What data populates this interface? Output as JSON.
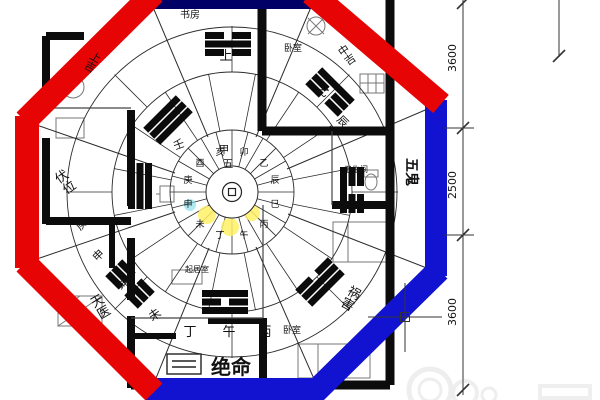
{
  "colors": {
    "octagon_red": "#e60404",
    "octagon_blue": "#1213d0",
    "octagon_navy": "#000066",
    "highlight_yellow": "#fff066",
    "highlight_cyan": "#7adcea"
  },
  "rooms": {
    "study": "书房",
    "bedroom_top": "卧室",
    "bathroom": "卫生间",
    "living": "起居室",
    "bedroom_bottom": "卧室"
  },
  "sectors": {
    "jueming": "绝命",
    "wugui": "五鬼",
    "fuwei": "伏位",
    "huohai": "祸害",
    "tianyi": "天医"
  },
  "grades": {
    "shang_ji": "上吉",
    "zhong_ji": "中吉"
  },
  "mountains": {
    "shang": "上",
    "jia": "甲",
    "five": "五",
    "ding": "丁",
    "wu": "午",
    "bing": "丙",
    "wei": "未",
    "ren": "壬",
    "yi": "乙",
    "chen": "辰",
    "geng": "庚",
    "shen": "申",
    "kun": "坤"
  },
  "ring": [
    {
      "char": "卯",
      "color": "#1f9d1f"
    },
    {
      "char": "乙",
      "color": "#13a3a3"
    },
    {
      "char": "辰",
      "color": "#2a2ad0"
    },
    {
      "char": "巳",
      "color": "#c32525"
    },
    {
      "char": "丙",
      "color": "#c32525"
    },
    {
      "char": "午",
      "color": "#8a8a15"
    },
    {
      "char": "丁",
      "color": "#13a3a3"
    },
    {
      "char": "未",
      "color": "#1f9d1f"
    },
    {
      "char": "申",
      "color": "#2a2ad0"
    },
    {
      "char": "庚",
      "color": "#c32525"
    },
    {
      "char": "酉",
      "color": "#1f9d1f"
    },
    {
      "char": "亥",
      "color": "#13a3a3"
    }
  ],
  "dimensions": {
    "top": "3600",
    "middle": "2500",
    "bottom": "3600"
  }
}
